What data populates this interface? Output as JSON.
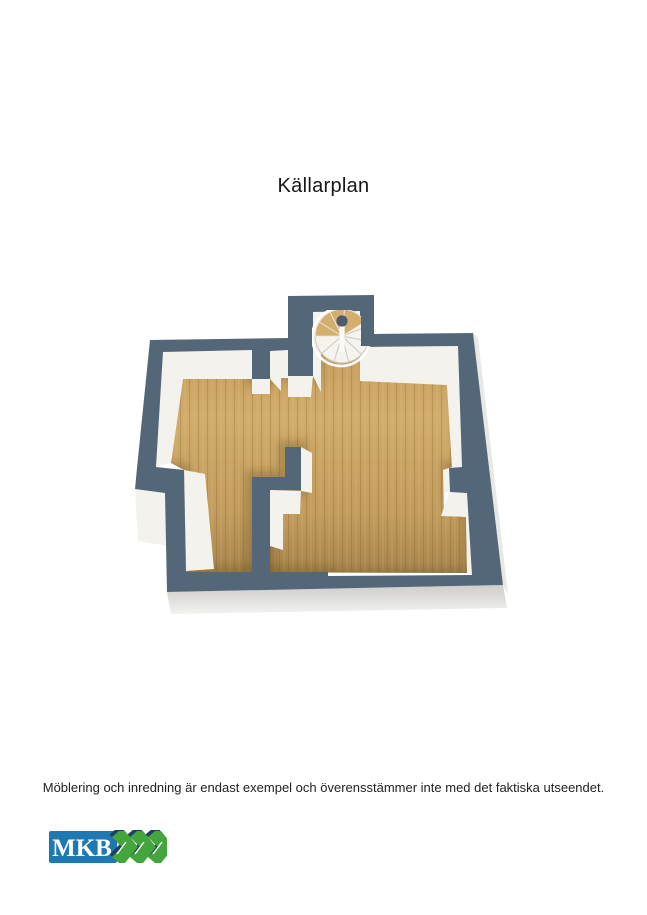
{
  "title": "Källarplan",
  "disclaimer": "Möblering och inredning är endast exempel och överensstämmer inte med det faktiska utseendet.",
  "floor_plan": {
    "floor_label": "Källarplan",
    "wall_top_color": "#546779",
    "wall_face_color": "#f4f2ec",
    "exterior_face_color": "#e9e8e4",
    "floor_light": "#d5b073",
    "floor_mid": "#c9a261",
    "floor_dark": "#a8854c",
    "stair_tread_white": "#f5f3ee",
    "stair_tread_wood": "#d4ae6d",
    "stair_pole_color": "#4a5c6e"
  },
  "logo": {
    "text": "MKB",
    "box_color": "#1e79b2",
    "text_color": "#ffffff",
    "chevron_color": "#43a53c",
    "chevron_shadow_color": "#1c3f63"
  }
}
